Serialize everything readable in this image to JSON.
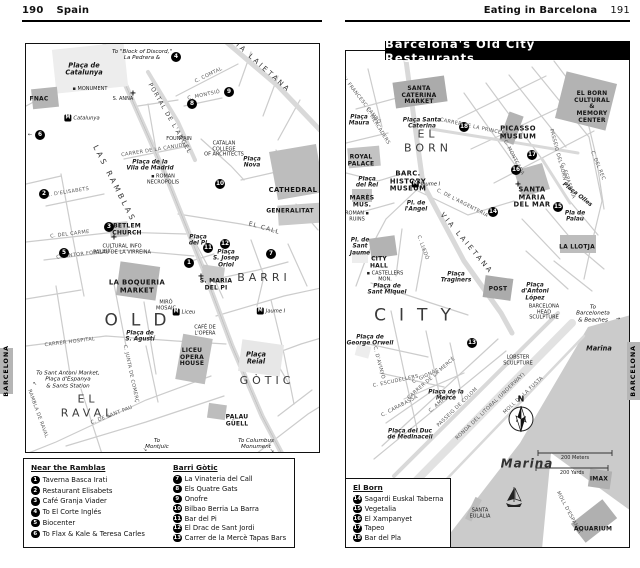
{
  "left_page": {
    "page_number": "190",
    "chapter": "Spain",
    "side_tab": "BARCELONA",
    "map": {
      "labels": [
        {
          "t": "To \"Block of Discord,\"\nLa Pedrera &",
          "c": "note",
          "x": 116,
          "y": 11
        },
        {
          "t": "Plaça de\nCatalunya",
          "c": "plaza-lg",
          "x": 58,
          "y": 26
        },
        {
          "t": "▪ MONUMENT",
          "c": "tiny",
          "x": 64,
          "y": 46
        },
        {
          "t": "FNAC",
          "c": "place",
          "x": 13,
          "y": 56
        },
        {
          "t": "S. ANNA",
          "c": "tiny",
          "x": 97,
          "y": 56
        },
        {
          "t": "+",
          "c": "cross",
          "x": 107,
          "y": 50
        },
        {
          "t": "VIA LAIETANA",
          "c": "street-lg",
          "x": 234,
          "y": 22,
          "r": 42
        },
        {
          "t": "C. COMTAL",
          "c": "street",
          "x": 183,
          "y": 32,
          "r": -26
        },
        {
          "t": "C. MONTSIÓ",
          "c": "street",
          "x": 178,
          "y": 52,
          "r": -12
        },
        {
          "t": "PORTAL DE L'ANGEL",
          "c": "street-md",
          "x": 143,
          "y": 75,
          "r": 60
        },
        {
          "t": "CARRER DE LA CANUDA",
          "c": "street",
          "x": 128,
          "y": 107,
          "r": -9
        },
        {
          "t": "Plaça de la\nVila de Madrid",
          "c": "plaza",
          "x": 124,
          "y": 122
        },
        {
          "t": "▪ ROMAN\nNECROPOLIS",
          "c": "tiny",
          "x": 137,
          "y": 136
        },
        {
          "t": "LAS RAMBLAS",
          "c": "ramblas",
          "x": 88,
          "y": 140,
          "r": 63
        },
        {
          "t": "FOUNTAIN",
          "c": "tiny",
          "x": 153,
          "y": 96
        },
        {
          "t": "CATALAN\nCOLLEGE\nOF ARCHITECTS",
          "c": "tiny",
          "x": 198,
          "y": 106
        },
        {
          "t": "Plaça\nNova",
          "c": "plaza",
          "x": 226,
          "y": 119
        },
        {
          "t": "CATHEDRAL",
          "c": "place-lg",
          "x": 267,
          "y": 147
        },
        {
          "t": "GENERALITAT",
          "c": "place",
          "x": 264,
          "y": 168
        },
        {
          "t": "EL CALL",
          "c": "street-md",
          "x": 238,
          "y": 185,
          "r": 16
        },
        {
          "t": "C. D'ELISABETS",
          "c": "street",
          "x": 42,
          "y": 149,
          "r": -9
        },
        {
          "t": "C. DEL CARME",
          "c": "street",
          "x": 44,
          "y": 191,
          "r": -7
        },
        {
          "t": "C. PINTOR FORTUNY",
          "c": "street",
          "x": 58,
          "y": 211,
          "r": -7
        },
        {
          "t": "BETLEM\nCHURCH",
          "c": "place",
          "x": 101,
          "y": 186
        },
        {
          "t": "+",
          "c": "cross",
          "x": 88,
          "y": 194
        },
        {
          "t": "Plaça\ndel Pi",
          "c": "plaza",
          "x": 172,
          "y": 197
        },
        {
          "t": "Plaça\nS. Josep\nOriol",
          "c": "plaza",
          "x": 200,
          "y": 215
        },
        {
          "t": "S. MARIA\nDEL PI",
          "c": "place",
          "x": 190,
          "y": 241
        },
        {
          "t": "+",
          "c": "cross",
          "x": 175,
          "y": 233
        },
        {
          "t": "BARRI",
          "c": "area",
          "x": 238,
          "y": 234
        },
        {
          "t": "GÒTIC",
          "c": "area",
          "x": 241,
          "y": 337
        },
        {
          "t": "CULTURAL INFO\nPALAU DE LA VIRREINA",
          "c": "tiny",
          "x": 96,
          "y": 206
        },
        {
          "t": "LA BOQUERIA\nMARKET",
          "c": "place-lg",
          "x": 111,
          "y": 243
        },
        {
          "t": "MIRÓ\nMOSAIC",
          "c": "tiny",
          "x": 140,
          "y": 262
        },
        {
          "t": "OLD",
          "c": "area-xl",
          "x": 116,
          "y": 277
        },
        {
          "t": "Plaça de\nS. Agustí",
          "c": "plaza",
          "x": 114,
          "y": 293
        },
        {
          "t": "CAFÉ DE\nL'OPERA",
          "c": "tiny",
          "x": 179,
          "y": 287
        },
        {
          "t": "LICEU\nOPERA\nHOUSE",
          "c": "place",
          "x": 166,
          "y": 314
        },
        {
          "t": "Plaça\nReial",
          "c": "plaza-lg",
          "x": 230,
          "y": 315
        },
        {
          "t": "C. JUNTA DE COMERÇ",
          "c": "street",
          "x": 104,
          "y": 330,
          "r": 78
        },
        {
          "t": "CARRER HOSPITAL",
          "c": "street",
          "x": 44,
          "y": 299,
          "r": -7
        },
        {
          "t": "C. DE SANT PAU",
          "c": "street",
          "x": 86,
          "y": 372,
          "r": -21
        },
        {
          "t": "EL\nRAVAL",
          "c": "area",
          "x": 62,
          "y": 363
        },
        {
          "t": "RAMBLA DE RAVAL",
          "c": "street",
          "x": 11,
          "y": 370,
          "r": 70
        },
        {
          "t": "To Sant Antoni Market,\nPlaça d'Espanya\n& Sants Station",
          "c": "note",
          "x": 42,
          "y": 336
        },
        {
          "t": "↖",
          "c": "tiny",
          "x": 9,
          "y": 341
        },
        {
          "t": "To\nMontjuïc",
          "c": "note",
          "x": 131,
          "y": 400
        },
        {
          "t": "↘",
          "c": "tiny",
          "x": 119,
          "y": 407
        },
        {
          "t": "PALAU\nGÜELL",
          "c": "place",
          "x": 211,
          "y": 377
        },
        {
          "t": "To Columbus\nMonument",
          "c": "note",
          "x": 230,
          "y": 400
        },
        {
          "t": "↘",
          "c": "tiny",
          "x": 246,
          "y": 408
        },
        {
          "t": "←",
          "c": "tiny",
          "x": 4,
          "y": 92
        }
      ],
      "markers": [
        {
          "n": "1",
          "x": 163,
          "y": 219
        },
        {
          "n": "2",
          "x": 18,
          "y": 150
        },
        {
          "n": "3",
          "x": 83,
          "y": 183
        },
        {
          "n": "4",
          "x": 150,
          "y": 13
        },
        {
          "n": "5",
          "x": 38,
          "y": 209
        },
        {
          "n": "6",
          "x": 14,
          "y": 91
        },
        {
          "n": "7",
          "x": 245,
          "y": 210
        },
        {
          "n": "8",
          "x": 166,
          "y": 60
        },
        {
          "n": "9",
          "x": 203,
          "y": 48
        },
        {
          "n": "10",
          "x": 194,
          "y": 140
        },
        {
          "n": "11",
          "x": 182,
          "y": 204
        },
        {
          "n": "12",
          "x": 199,
          "y": 200
        }
      ],
      "metros": [
        {
          "name": "Catalunya",
          "x": 56,
          "y": 74
        },
        {
          "name": "Liceu",
          "x": 158,
          "y": 268
        },
        {
          "name": "Jaume I",
          "x": 245,
          "y": 267
        }
      ]
    },
    "legend": {
      "columns": [
        {
          "heading": "Near the Ramblas",
          "items": [
            {
              "num": "1",
              "label": "Taverna Basca Irati"
            },
            {
              "num": "2",
              "label": "Restaurant Elisabets"
            },
            {
              "num": "3",
              "label": "Café Granja Viader"
            },
            {
              "num": "4",
              "label": "To El Corte Inglés"
            },
            {
              "num": "5",
              "label": "Biocenter"
            },
            {
              "num": "6",
              "label": "To Flax & Kale & Teresa Carles"
            }
          ]
        },
        {
          "heading": "Barri Gòtic",
          "items": [
            {
              "num": "7",
              "label": "La Vinateria del Call"
            },
            {
              "num": "8",
              "label": "Els Quatre Gats"
            },
            {
              "num": "9",
              "label": "Onofre"
            },
            {
              "num": "10",
              "label": "Bilbao Berria La Barra"
            },
            {
              "num": "11",
              "label": "Bar del Pi"
            },
            {
              "num": "12",
              "label": "El Drac de Sant Jordi"
            },
            {
              "num": "13",
              "label": "Carrer de la Mercè Tapas Bars"
            }
          ]
        }
      ]
    }
  },
  "right_page": {
    "header": "Eating in Barcelona",
    "page_number": "191",
    "banner": "Barcelona's Old City Restaurants",
    "side_tab": "BARCELONA",
    "map": {
      "labels": [
        {
          "t": "SANTA\nCATERINA\nMARKET",
          "c": "place",
          "x": 73,
          "y": 45
        },
        {
          "t": "Plaça\nMaura",
          "c": "plaza",
          "x": 13,
          "y": 70
        },
        {
          "t": "Plaça Santa\nCaterina",
          "c": "plaza",
          "x": 76,
          "y": 73
        },
        {
          "t": "AV. FRANCESC CAMBÓ",
          "c": "street",
          "x": 14,
          "y": 49,
          "r": 52
        },
        {
          "t": "C. MERCADERS",
          "c": "street",
          "x": 31,
          "y": 76,
          "r": 58
        },
        {
          "t": "EL\nBORN",
          "c": "area",
          "x": 82,
          "y": 91
        },
        {
          "t": "CARRER DE LA PRINCESA",
          "c": "street",
          "x": 128,
          "y": 77,
          "r": 12
        },
        {
          "t": "EL BORN\nCULTURAL &\nMEMORY\nCENTER",
          "c": "place",
          "x": 246,
          "y": 57
        },
        {
          "t": "PICASSO\nMUSEUM",
          "c": "place-lg",
          "x": 172,
          "y": 82
        },
        {
          "t": "C. MONTCADA",
          "c": "street",
          "x": 167,
          "y": 107,
          "r": 62
        },
        {
          "t": "PASSEIG DEL BORN",
          "c": "street",
          "x": 211,
          "y": 104,
          "r": 75
        },
        {
          "t": "C. DEL REC",
          "c": "street",
          "x": 251,
          "y": 115,
          "r": 68
        },
        {
          "t": "C. ESPASERIA",
          "c": "street",
          "x": 221,
          "y": 130,
          "r": 72
        },
        {
          "t": "ROYAL\nPALACE",
          "c": "place",
          "x": 15,
          "y": 110
        },
        {
          "t": "Plaça\ndel Rei",
          "c": "plaza",
          "x": 21,
          "y": 132
        },
        {
          "t": "BARC.\nHISTORY\nMUSEUM",
          "c": "place-lg",
          "x": 62,
          "y": 131
        },
        {
          "t": "Pl. de\nl'Angel",
          "c": "plaza",
          "x": 70,
          "y": 156
        },
        {
          "t": "MARÈS\nMUS.",
          "c": "place",
          "x": 16,
          "y": 151
        },
        {
          "t": "ROMAN ▪\nRUINS",
          "c": "tiny",
          "x": 11,
          "y": 166
        },
        {
          "t": "VIA LAIETANA",
          "c": "street-lg",
          "x": 120,
          "y": 193,
          "r": 50
        },
        {
          "t": "C. DE L'ARGENTERIA",
          "c": "street",
          "x": 116,
          "y": 153,
          "r": 27
        },
        {
          "t": "SANTA\nMARIA\nDEL MAR",
          "c": "place-lg",
          "x": 186,
          "y": 147
        },
        {
          "t": "+",
          "c": "cross",
          "x": 172,
          "y": 134
        },
        {
          "t": "Plaça Olles",
          "c": "plaza",
          "x": 231,
          "y": 144,
          "r": 38
        },
        {
          "t": "Pla de\nPalau",
          "c": "plaza",
          "x": 229,
          "y": 166
        },
        {
          "t": "LA LLOTJA",
          "c": "place",
          "x": 231,
          "y": 197
        },
        {
          "t": "Pl. de\nSant\nJaume",
          "c": "plaza",
          "x": 14,
          "y": 196
        },
        {
          "t": "CITY\nHALL",
          "c": "place",
          "x": 33,
          "y": 212
        },
        {
          "t": "▪ CASTELLERS\nMON.",
          "c": "tiny",
          "x": 39,
          "y": 226
        },
        {
          "t": "Plaça de\nSant Miquel",
          "c": "plaza",
          "x": 41,
          "y": 239
        },
        {
          "t": "C. LLEDÓ",
          "c": "street",
          "x": 76,
          "y": 197,
          "r": 70
        },
        {
          "t": "Plaça\nTraginers",
          "c": "plaza",
          "x": 110,
          "y": 227
        },
        {
          "t": "CITY",
          "c": "area-xl",
          "x": 73,
          "y": 265
        },
        {
          "t": "Plaça de\nGeorge Orwell",
          "c": "plaza",
          "x": 24,
          "y": 290
        },
        {
          "t": "C. D'AVINYÓ",
          "c": "street",
          "x": 32,
          "y": 312,
          "r": 75
        },
        {
          "t": "C. ESCUDELLERS",
          "c": "street",
          "x": 50,
          "y": 331,
          "r": -12
        },
        {
          "t": "C. GIGNÀS",
          "c": "street",
          "x": 80,
          "y": 326,
          "r": -25
        },
        {
          "t": "C. CARABASSA",
          "c": "street",
          "x": 54,
          "y": 356,
          "r": -28
        },
        {
          "t": "C. AMPLE",
          "c": "street",
          "x": 94,
          "y": 353,
          "r": -40
        },
        {
          "t": "POST",
          "c": "place",
          "x": 152,
          "y": 239
        },
        {
          "t": "Plaça\nd'Antoni\nLópez",
          "c": "plaza",
          "x": 189,
          "y": 241
        },
        {
          "t": "BARCELONA\nHEAD\nSCULPTURE",
          "c": "tiny",
          "x": 198,
          "y": 262
        },
        {
          "t": "To Barceloneta\n& Beaches",
          "c": "note",
          "x": 247,
          "y": 263
        },
        {
          "t": "→",
          "c": "tiny",
          "x": 272,
          "y": 269
        },
        {
          "t": "LOBSTER\nSCULPTURE",
          "c": "tiny",
          "x": 172,
          "y": 310
        },
        {
          "t": "CARRER DE LA MERCÈ",
          "c": "street",
          "x": 86,
          "y": 328,
          "r": -41
        },
        {
          "t": "Plaça de la\nMercè",
          "c": "plaza",
          "x": 100,
          "y": 345
        },
        {
          "t": "Plaça del Duc\nde Medinaceli",
          "c": "plaza",
          "x": 64,
          "y": 384
        },
        {
          "t": "PASSEIG DE COLOM",
          "c": "street",
          "x": 112,
          "y": 357,
          "r": -44
        },
        {
          "t": "RONDA DEL LITORAL (UNDERWAY)",
          "c": "street",
          "x": 145,
          "y": 356,
          "r": -44
        },
        {
          "t": "MOLL DE LA FUSTA",
          "c": "street",
          "x": 178,
          "y": 345,
          "r": -43
        },
        {
          "t": "Marina",
          "c": "plaza-lg",
          "x": 253,
          "y": 298
        },
        {
          "t": "N",
          "c": "compass-n",
          "x": 175,
          "y": 349
        },
        {
          "t": "200 Meters",
          "c": "tiny",
          "x": 229,
          "y": 408
        },
        {
          "t": "200 Yards",
          "c": "tiny",
          "x": 226,
          "y": 423
        },
        {
          "t": "Marina",
          "c": "marina-lg",
          "x": 181,
          "y": 413
        },
        {
          "t": "SANTA\nEULÀLIA",
          "c": "tiny",
          "x": 134,
          "y": 463
        },
        {
          "t": "MOLL D'ESPANYA",
          "c": "street",
          "x": 222,
          "y": 462,
          "r": 62
        },
        {
          "t": "IMAX",
          "c": "place",
          "x": 253,
          "y": 429
        },
        {
          "t": "AQUARIUM",
          "c": "place",
          "x": 247,
          "y": 479
        }
      ],
      "markers": [
        {
          "n": "13",
          "x": 126,
          "y": 292
        },
        {
          "n": "14",
          "x": 147,
          "y": 161
        },
        {
          "n": "15",
          "x": 212,
          "y": 156
        },
        {
          "n": "16",
          "x": 170,
          "y": 119
        },
        {
          "n": "17",
          "x": 186,
          "y": 104
        },
        {
          "n": "18",
          "x": 118,
          "y": 76
        }
      ],
      "metros": [
        {
          "name": "Jaume I",
          "x": 80,
          "y": 133
        }
      ]
    },
    "legend": {
      "columns": [
        {
          "heading": "El Born",
          "items": [
            {
              "num": "14",
              "label": "Sagardi Euskal Taberna"
            },
            {
              "num": "15",
              "label": "Vegetalia"
            },
            {
              "num": "16",
              "label": "El Xampanyet"
            },
            {
              "num": "17",
              "label": "Tapeo"
            },
            {
              "num": "18",
              "label": "Bar del Pla"
            }
          ]
        }
      ]
    }
  }
}
